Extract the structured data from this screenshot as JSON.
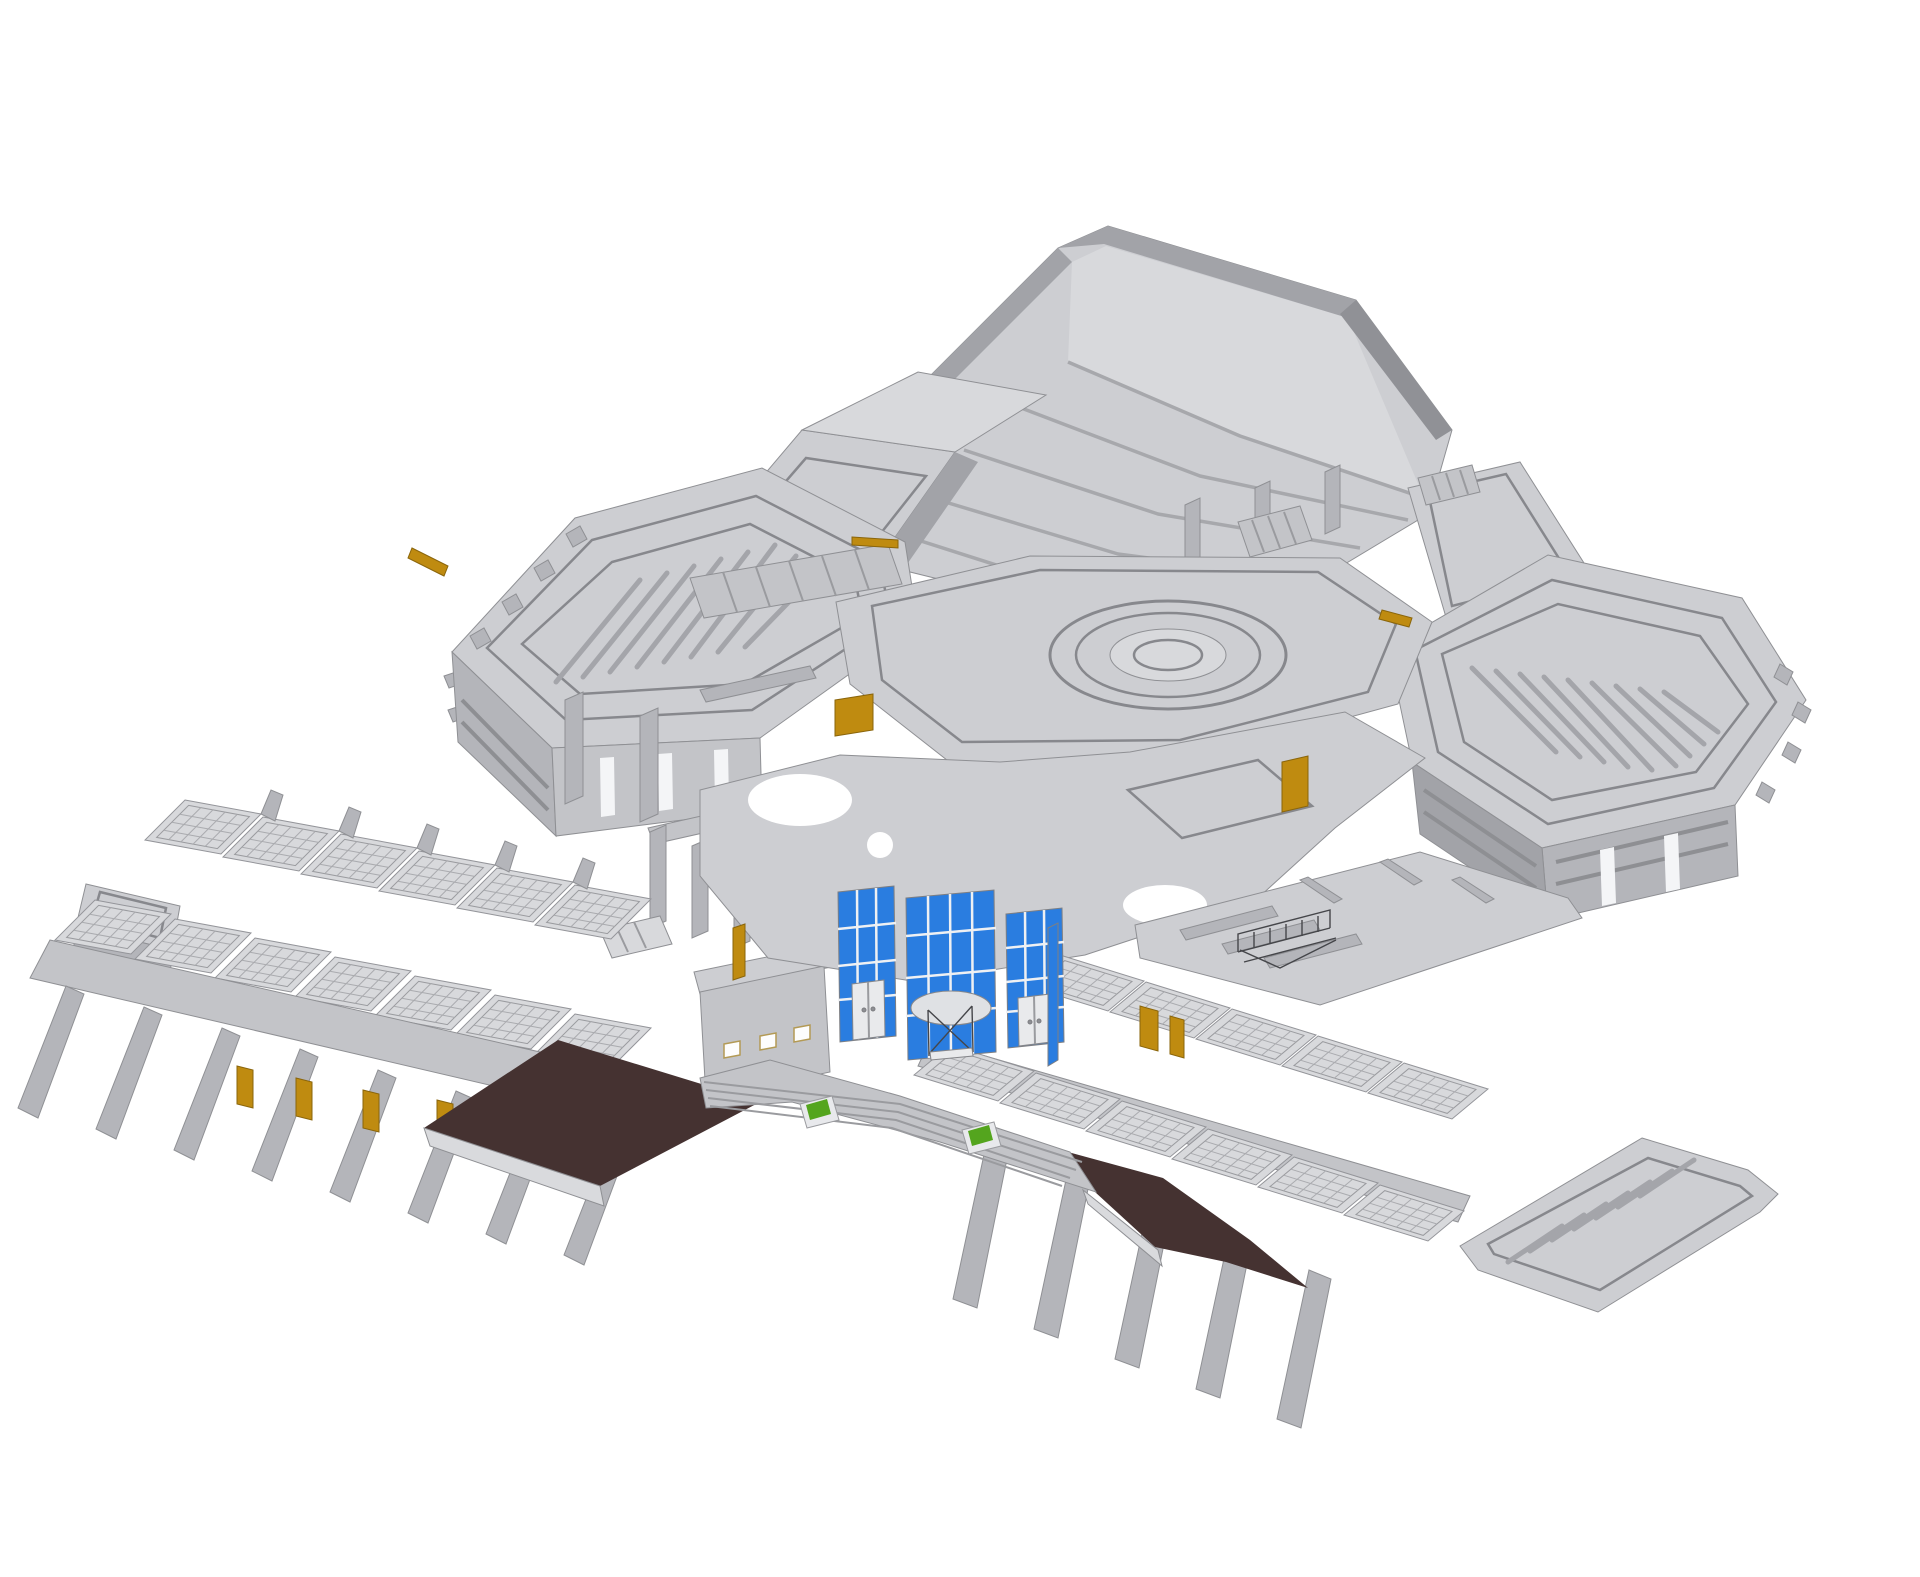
{
  "scene": {
    "type": "3d-architectural-model",
    "view": "isometric overview, white background",
    "background": "#ffffff"
  },
  "palette": {
    "background": "#ffffff",
    "gray_top_light": "#d8d9dc",
    "gray_top": "#cdced2",
    "gray_top_dark": "#c3c4c8",
    "gray_side_light": "#b4b5ba",
    "gray_side": "#a2a3a8",
    "gray_side_dark": "#909196",
    "edge_line": "#8f9094",
    "glass_blue": "#2a7de0",
    "mullion_white": "#eef0f3",
    "door_gold": "#bf8b10",
    "door_gold_dark": "#8a650b",
    "ramp_brown": "#453231",
    "curb_light": "#d9dadd",
    "planter_green": "#54a51e",
    "stair_wire": "#45464a",
    "door_leaf_white": "#e9eaec"
  },
  "parts": {
    "auditorium_hall": {
      "color_key": "gray_top"
    },
    "tiered_seating_rows": {
      "count": 5
    },
    "central_hex_plaza": {
      "color_key": "gray_top"
    },
    "amphitheater_rings": {
      "count": 4
    },
    "left_pentagon_hall": {
      "striped_roof_bars": 8
    },
    "right_pentagon_hall": {
      "striped_roof_bars": 9
    },
    "left_classroom_wing": {
      "skylight_modules": 13,
      "fin_walls": 8
    },
    "right_classroom_wing": {
      "skylight_modules": 11,
      "fin_walls": 5
    },
    "entrance_curtain_wall": {
      "glass_panels": 3,
      "doors": 3,
      "color_key": "glass_blue"
    },
    "timber_doors": {
      "count": 10,
      "color_key": "door_gold"
    },
    "approach_ramps": {
      "count": 2,
      "color_key": "ramp_brown"
    },
    "entry_walkway": {
      "planters": 2
    },
    "planter_boxes": {
      "count": 2,
      "color_key": "planter_green"
    },
    "open_stair_frame": {
      "color_key": "stair_wire"
    }
  }
}
